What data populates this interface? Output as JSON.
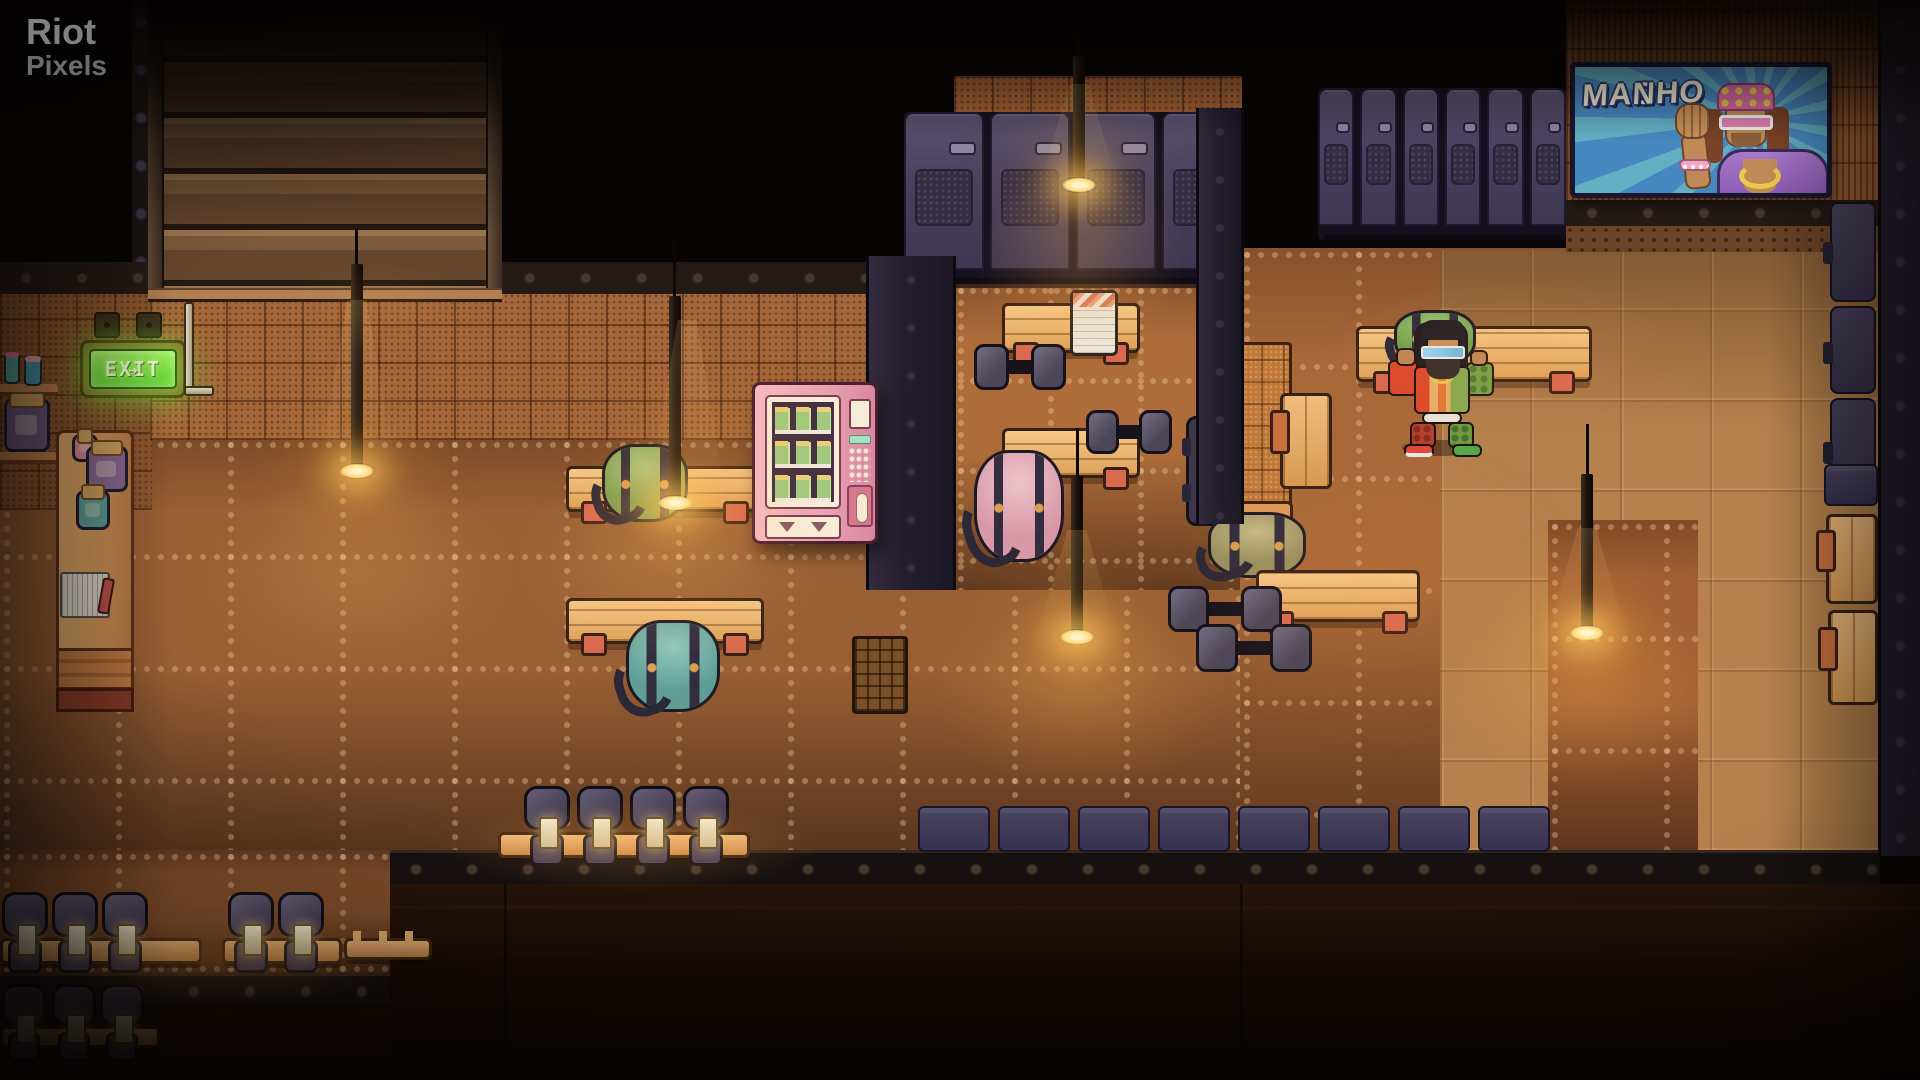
{
  "watermark": {
    "line1": "Riot",
    "line2": "Pixels"
  },
  "exit_sign": {
    "label": "EXIT",
    "arrow": "➜",
    "glow_color": "#6ee23c"
  },
  "poster": {
    "line1": "MACHO",
    "line2": "MAN",
    "bg_color": "#4888c0",
    "text_color": "#f2ead0"
  },
  "palette": {
    "background": "#070403",
    "floor_base": "#9a6035",
    "floor_lit": "#c9965e",
    "floor_dark": "#7c4a28",
    "wall_orange": "#a5673a",
    "band_dark": "#231a16",
    "locker_purple": "#4a4260",
    "bench_wood": "#e8b06a",
    "bench_leg": "#d96a50",
    "lamp_glow": "#ffd878",
    "vending_pink": "#eca3b2",
    "bottom_ledge": "#170b05",
    "player_jacket_red": "#dd4a2e",
    "player_camo_green": "#76a246"
  },
  "scene": {
    "objects": [
      {
        "t": "bench-h",
        "n": "bench",
        "x": 566,
        "y": 466,
        "w": 198,
        "h": 46
      },
      {
        "t": "bag",
        "n": "gym-bag-green",
        "x": 602,
        "y": 444,
        "w": 86,
        "h": 78,
        "c1": "#7ba054",
        "c2": "#aeca85"
      },
      {
        "t": "bench-h",
        "n": "bench",
        "x": 566,
        "y": 598,
        "w": 198,
        "h": 46
      },
      {
        "t": "bag",
        "n": "gym-bag-teal",
        "x": 626,
        "y": 620,
        "w": 94,
        "h": 92,
        "c1": "#5f9e96",
        "c2": "#92c8bd"
      },
      {
        "t": "bench-h",
        "n": "bench",
        "x": 1002,
        "y": 303,
        "w": 138,
        "h": 50
      },
      {
        "t": "towel",
        "n": "towel",
        "x": 1070,
        "y": 290,
        "w": 48,
        "h": 66
      },
      {
        "t": "dumbbell",
        "n": "dumbbell",
        "x": 974,
        "y": 344,
        "w": 92,
        "h": 46
      },
      {
        "t": "bench-h",
        "n": "bench",
        "x": 1002,
        "y": 428,
        "w": 138,
        "h": 50
      },
      {
        "t": "dumbbell",
        "n": "dumbbell",
        "x": 1086,
        "y": 410,
        "w": 86,
        "h": 44
      },
      {
        "t": "bag",
        "n": "gym-bag-pink",
        "x": 974,
        "y": 450,
        "w": 90,
        "h": 112,
        "c1": "#d898a8",
        "c2": "#eec3ca"
      },
      {
        "t": "machine",
        "n": "wall-machine",
        "x": 1830,
        "y": 202,
        "w": 46,
        "h": 100
      },
      {
        "t": "machine",
        "n": "wall-machine",
        "x": 1830,
        "y": 306,
        "w": 46,
        "h": 88
      },
      {
        "t": "machine",
        "n": "wall-machine",
        "x": 1830,
        "y": 398,
        "w": 46,
        "h": 108
      },
      {
        "t": "crate",
        "n": "storage-crate",
        "x": 1824,
        "y": 464,
        "w": 54,
        "h": 42
      },
      {
        "t": "bench-v",
        "n": "bench",
        "x": 1826,
        "y": 514,
        "w": 52,
        "h": 90
      },
      {
        "t": "bench-v",
        "n": "bench",
        "x": 1828,
        "y": 610,
        "w": 50,
        "h": 95
      },
      {
        "t": "mat-dark",
        "n": "equipment-mat",
        "x": 1186,
        "y": 416,
        "w": 54,
        "h": 110
      },
      {
        "t": "pillar-orange",
        "n": "training-station",
        "x": 1236,
        "y": 342,
        "w": 56,
        "h": 176
      },
      {
        "t": "bag",
        "n": "gym-bag-olive",
        "x": 1208,
        "y": 512,
        "w": 98,
        "h": 66,
        "c1": "#9a9060",
        "c2": "#c6ba88"
      },
      {
        "t": "bench-h",
        "n": "bench",
        "x": 1256,
        "y": 570,
        "w": 164,
        "h": 52
      },
      {
        "t": "dumbbell",
        "n": "dumbbell",
        "x": 1168,
        "y": 586,
        "w": 114,
        "h": 46
      },
      {
        "t": "dumbbell",
        "n": "dumbbell",
        "x": 1196,
        "y": 624,
        "w": 116,
        "h": 48
      },
      {
        "t": "bench-v",
        "n": "bench",
        "x": 1280,
        "y": 393,
        "w": 52,
        "h": 96
      },
      {
        "t": "bench-h",
        "n": "bench",
        "x": 1356,
        "y": 326,
        "w": 236,
        "h": 56
      },
      {
        "t": "bag",
        "n": "duffel-green",
        "x": 1394,
        "y": 310,
        "w": 82,
        "h": 56,
        "c1": "#6fa050",
        "c2": "#a2c878"
      },
      {
        "t": "locker-bank",
        "n": "locker-bank-main",
        "x": 904,
        "y": 112,
        "w": 338,
        "h": 172,
        "doors": 4,
        "i": 1
      },
      {
        "t": "locker-bank small",
        "n": "locker-bank-right",
        "x": 1318,
        "y": 88,
        "w": 248,
        "h": 152,
        "doors": 6,
        "i": 1
      },
      {
        "t": "grate",
        "n": "floor-grate",
        "x": 852,
        "y": 636,
        "w": 56,
        "h": 78
      },
      {
        "t": "crate",
        "n": "crate",
        "x": 918,
        "y": 806,
        "w": 72,
        "h": 46
      },
      {
        "t": "crate",
        "n": "crate",
        "x": 998,
        "y": 806,
        "w": 72,
        "h": 46
      },
      {
        "t": "crate",
        "n": "crate",
        "x": 1078,
        "y": 806,
        "w": 72,
        "h": 46
      },
      {
        "t": "crate",
        "n": "crate",
        "x": 1158,
        "y": 806,
        "w": 72,
        "h": 46
      },
      {
        "t": "crate",
        "n": "crate",
        "x": 1238,
        "y": 806,
        "w": 72,
        "h": 46
      },
      {
        "t": "crate",
        "n": "crate",
        "x": 1318,
        "y": 806,
        "w": 72,
        "h": 46
      },
      {
        "t": "crate",
        "n": "crate",
        "x": 1398,
        "y": 806,
        "w": 72,
        "h": 46
      },
      {
        "t": "crate",
        "n": "crate",
        "x": 1478,
        "y": 806,
        "w": 72,
        "h": 46
      },
      {
        "t": "rack",
        "n": "dumbbell-rack",
        "x": 498,
        "y": 832,
        "w": 252,
        "h": 26
      },
      {
        "t": "dumbbell-v",
        "n": "standing-dumbbell",
        "x": 524,
        "y": 786,
        "w": 46,
        "h": 82
      },
      {
        "t": "dumbbell-v",
        "n": "standing-dumbbell",
        "x": 577,
        "y": 786,
        "w": 46,
        "h": 82
      },
      {
        "t": "dumbbell-v",
        "n": "standing-dumbbell",
        "x": 630,
        "y": 786,
        "w": 46,
        "h": 82
      },
      {
        "t": "dumbbell-v",
        "n": "standing-dumbbell",
        "x": 683,
        "y": 786,
        "w": 46,
        "h": 82
      },
      {
        "t": "rack",
        "n": "dumbbell-rack",
        "x": 0,
        "y": 938,
        "w": 202,
        "h": 26
      },
      {
        "t": "dumbbell-v",
        "n": "standing-dumbbell",
        "x": 2,
        "y": 892,
        "w": 46,
        "h": 84
      },
      {
        "t": "dumbbell-v",
        "n": "standing-dumbbell",
        "x": 52,
        "y": 892,
        "w": 46,
        "h": 84
      },
      {
        "t": "dumbbell-v",
        "n": "standing-dumbbell",
        "x": 102,
        "y": 892,
        "w": 46,
        "h": 84
      },
      {
        "t": "rack",
        "n": "dumbbell-rack",
        "x": 222,
        "y": 938,
        "w": 120,
        "h": 26
      },
      {
        "t": "dumbbell-v",
        "n": "standing-dumbbell",
        "x": 228,
        "y": 892,
        "w": 46,
        "h": 84
      },
      {
        "t": "dumbbell-v",
        "n": "standing-dumbbell",
        "x": 278,
        "y": 892,
        "w": 46,
        "h": 84
      },
      {
        "t": "rack-pegs",
        "n": "empty-rack",
        "x": 344,
        "y": 938,
        "w": 88,
        "h": 22
      },
      {
        "t": "rack",
        "n": "dumbbell-rack",
        "x": 0,
        "y": 1026,
        "w": 160,
        "h": 22,
        "dim": 1
      },
      {
        "t": "dumbbell-v",
        "n": "standing-dumbbell",
        "x": 2,
        "y": 984,
        "w": 44,
        "h": 78,
        "dim": 1
      },
      {
        "t": "dumbbell-v",
        "n": "standing-dumbbell",
        "x": 52,
        "y": 984,
        "w": 44,
        "h": 78,
        "dim": 1
      },
      {
        "t": "dumbbell-v",
        "n": "standing-dumbbell",
        "x": 100,
        "y": 984,
        "w": 44,
        "h": 78,
        "dim": 1
      },
      {
        "t": "cord",
        "n": "lamp-cord",
        "x": 355,
        "y": 228,
        "w": 3,
        "h": 44,
        "l": "fx"
      },
      {
        "t": "cord",
        "n": "lamp-cord",
        "x": 673,
        "y": 240,
        "w": 3,
        "h": 62,
        "l": "fx"
      },
      {
        "t": "cord",
        "n": "lamp-cord",
        "x": 1077,
        "y": 28,
        "w": 3,
        "h": 34,
        "l": "fx"
      },
      {
        "t": "cord",
        "n": "lamp-cord",
        "x": 1076,
        "y": 428,
        "w": 3,
        "h": 54,
        "l": "fx"
      },
      {
        "t": "cord",
        "n": "lamp-cord",
        "x": 1586,
        "y": 424,
        "w": 3,
        "h": 56,
        "l": "fx"
      },
      {
        "t": "lamp",
        "n": "hanging-lamp",
        "x": 344,
        "y": 264,
        "w": 26,
        "h": 212,
        "l": "fx"
      },
      {
        "t": "lamp",
        "n": "hanging-lamp",
        "x": 662,
        "y": 296,
        "w": 26,
        "h": 212,
        "l": "fx"
      },
      {
        "t": "lamp",
        "n": "hanging-lamp",
        "x": 1066,
        "y": 56,
        "w": 26,
        "h": 134,
        "l": "fx"
      },
      {
        "t": "lamp",
        "n": "hanging-lamp",
        "x": 1064,
        "y": 476,
        "w": 26,
        "h": 166,
        "l": "fx"
      },
      {
        "t": "lamp",
        "n": "hanging-lamp",
        "x": 1574,
        "y": 474,
        "w": 26,
        "h": 164,
        "l": "fx"
      },
      {
        "t": "cone",
        "n": "light-cone",
        "x": 318,
        "y": 300,
        "w": 78,
        "h": 170,
        "l": "fx"
      },
      {
        "t": "cone",
        "n": "light-cone",
        "x": 648,
        "y": 320,
        "w": 78,
        "h": 180,
        "l": "fx"
      },
      {
        "t": "cone",
        "n": "light-cone",
        "x": 1040,
        "y": 84,
        "w": 78,
        "h": 100,
        "l": "fx"
      },
      {
        "t": "cone",
        "n": "light-cone",
        "x": 1038,
        "y": 530,
        "w": 78,
        "h": 104,
        "l": "fx"
      },
      {
        "t": "cone",
        "n": "light-cone",
        "x": 1548,
        "y": 528,
        "w": 78,
        "h": 106,
        "l": "fx"
      },
      {
        "t": "pool",
        "n": "light-pool",
        "x": 140,
        "y": 440,
        "w": 440,
        "h": 270,
        "tint": "rgba(255,180,90,.20)",
        "l": "fx"
      },
      {
        "t": "pool",
        "n": "light-pool",
        "x": 450,
        "y": 420,
        "w": 440,
        "h": 280,
        "tint": "rgba(255,180,90,.20)",
        "l": "fx"
      },
      {
        "t": "pool",
        "n": "light-pool",
        "x": 930,
        "y": 130,
        "w": 300,
        "h": 270,
        "tint": "rgba(255,170,80,.22)",
        "l": "fx"
      },
      {
        "t": "pool",
        "n": "light-pool",
        "x": 870,
        "y": 560,
        "w": 420,
        "h": 270,
        "tint": "rgba(255,175,80,.22)",
        "l": "fx"
      },
      {
        "t": "pool",
        "n": "light-pool",
        "x": 1380,
        "y": 560,
        "w": 420,
        "h": 270,
        "tint": "rgba(255,175,80,.22)",
        "l": "fx"
      },
      {
        "t": "pool",
        "n": "light-pool",
        "x": 1080,
        "y": 360,
        "w": 600,
        "h": 460,
        "tint": "rgba(255,150,70,.10)",
        "l": "fx"
      },
      {
        "t": "pool",
        "n": "light-pool",
        "x": 360,
        "y": 780,
        "w": 540,
        "h": 130,
        "tint": "rgba(255,170,80,.22)",
        "l": "fx"
      },
      {
        "t": "pool",
        "n": "light-pool",
        "x": -40,
        "y": 890,
        "w": 520,
        "h": 140,
        "tint": "rgba(255,170,80,.20)",
        "l": "fx"
      },
      {
        "t": "pool",
        "n": "light-pool",
        "x": 540,
        "y": 300,
        "w": 340,
        "h": 300,
        "tint": "rgba(255,160,70,.12)",
        "l": "fx"
      },
      {
        "t": "pool",
        "n": "light-pool",
        "x": 1240,
        "y": 240,
        "w": 560,
        "h": 230,
        "tint": "rgba(255,150,70,.10)",
        "l": "fx"
      },
      {
        "t": "pool",
        "n": "light-pool",
        "x": 230,
        "y": 240,
        "w": 300,
        "h": 130,
        "tint": "rgba(255,170,80,.10)",
        "l": "fx"
      },
      {
        "t": "pool",
        "n": "exit-glow",
        "x": 16,
        "y": 316,
        "w": 250,
        "h": 130,
        "tint": "rgba(130,235,70,.15)",
        "l": "fx"
      }
    ]
  }
}
